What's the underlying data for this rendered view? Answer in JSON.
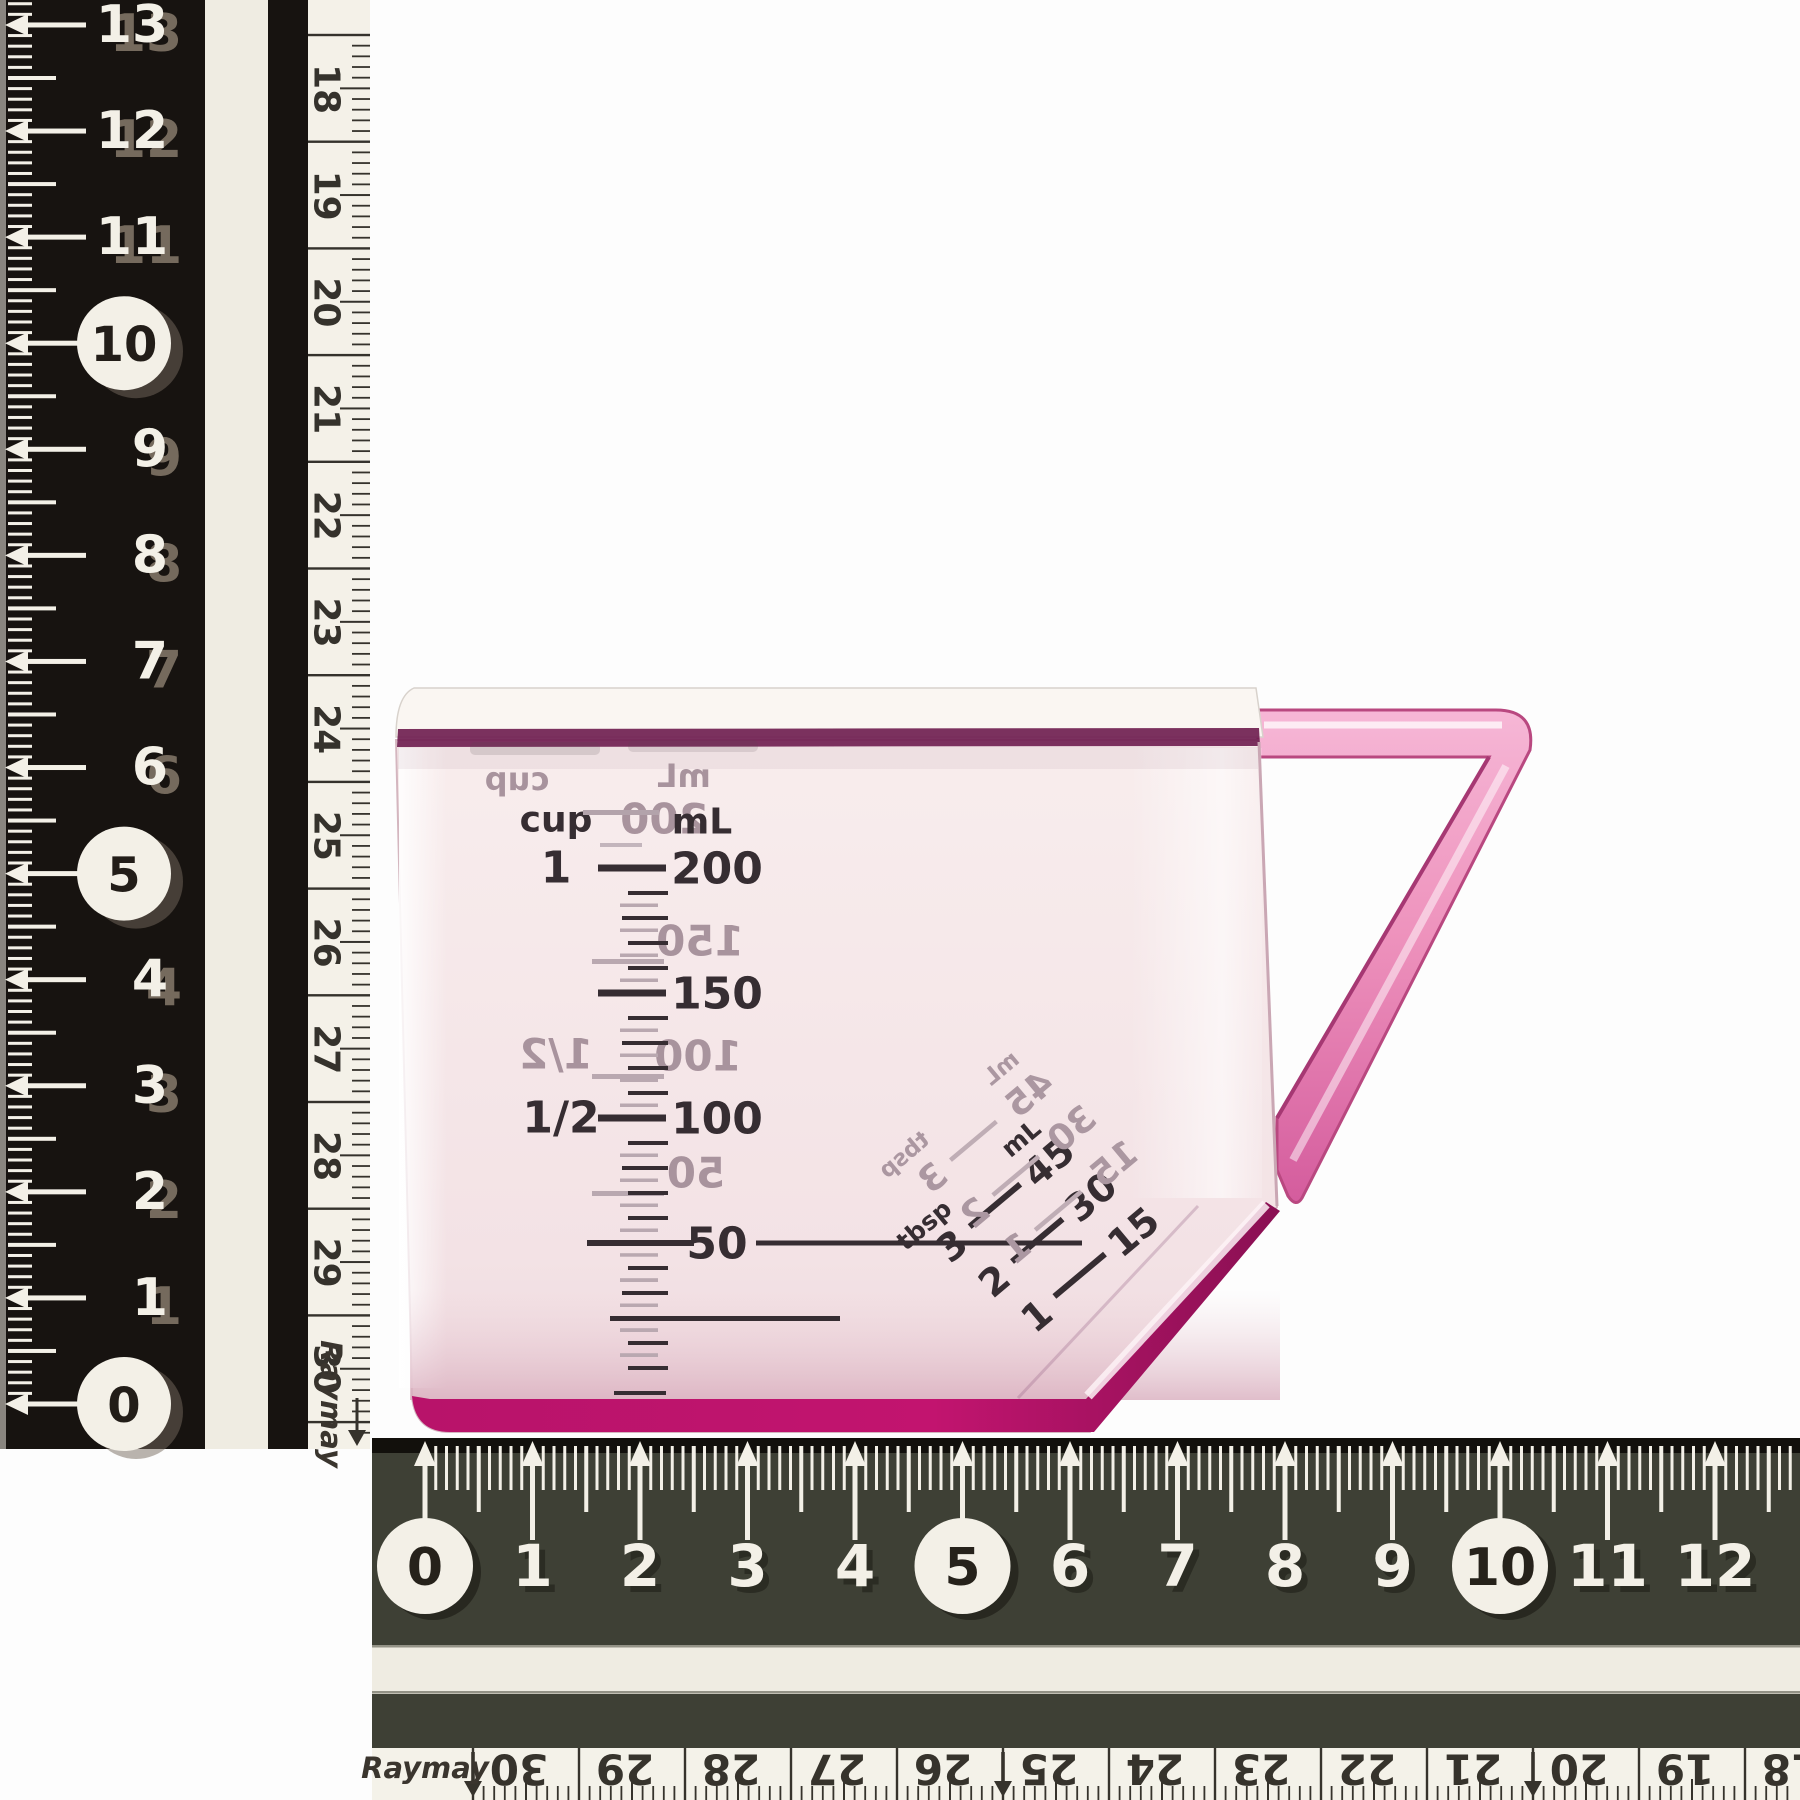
{
  "background": "#fdfdfd",
  "vertical_ruler": {
    "brand": "Raymay",
    "main_scale": {
      "numbers": [
        "0",
        "1",
        "2",
        "3",
        "4",
        "5",
        "6",
        "7",
        "8",
        "9",
        "10",
        "11",
        "12",
        "13"
      ],
      "circled": [
        "0",
        "5",
        "10"
      ]
    },
    "reverse_scale": {
      "numbers": [
        "18",
        "19",
        "20",
        "21",
        "22",
        "23",
        "24",
        "25",
        "26",
        "27",
        "28",
        "29",
        "30"
      ]
    },
    "colors": {
      "body": "#171310",
      "marks": "#f3f0e7",
      "stripe": "#efece2",
      "edge_strip": "#f4f1e8",
      "reverse_text": "#35322c"
    }
  },
  "horizontal_ruler": {
    "brand": "Raymay",
    "main_scale": {
      "numbers": [
        "0",
        "1",
        "2",
        "3",
        "4",
        "5",
        "6",
        "7",
        "8",
        "9",
        "10",
        "11",
        "12"
      ],
      "circled": [
        "0",
        "5",
        "10"
      ]
    },
    "reverse_scale": {
      "numbers": [
        "30",
        "29",
        "28",
        "27",
        "26",
        "25",
        "24",
        "23",
        "22",
        "21",
        "20",
        "19",
        "18"
      ],
      "arrowed": [
        "30",
        "25",
        "20"
      ]
    },
    "colors": {
      "body": "#3e4035",
      "top_edge": "#12100c",
      "marks": "#f3f0e7",
      "stripe": "#efece2",
      "bottom_strip": "#f4f2e9",
      "reverse_text": "#36332c"
    }
  },
  "measuring_cup": {
    "colors": {
      "body": "#f6e9e9",
      "rim_line": "#702051",
      "bottom_edge": "#c01270",
      "handle": "#ef9cc2",
      "scale_text": "#362d32",
      "ghost_text": "#a8939d"
    },
    "front_scale": {
      "col_headers": [
        "cup",
        "mL"
      ],
      "rows": [
        {
          "cup": "1",
          "ml": "200"
        },
        {
          "cup": "",
          "ml": "150"
        },
        {
          "cup": "1/2",
          "ml": "100"
        },
        {
          "cup": "",
          "ml": "50"
        }
      ]
    },
    "diagonal_scale": {
      "col_headers": [
        "tbsp",
        "mL"
      ],
      "rows": [
        {
          "tbsp": "3",
          "ml": "45"
        },
        {
          "tbsp": "2",
          "ml": "30"
        },
        {
          "tbsp": "1",
          "ml": "15"
        }
      ]
    }
  }
}
